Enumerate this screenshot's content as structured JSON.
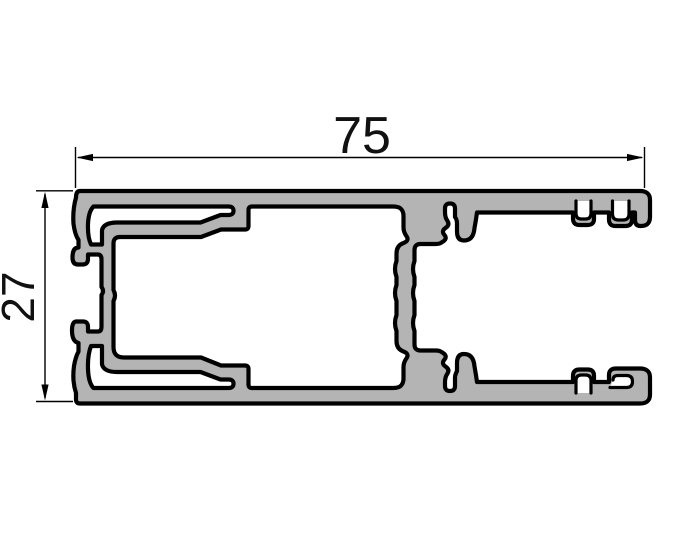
{
  "drawing": {
    "kind": "aluminium-profile-cross-section",
    "background_color": "#ffffff",
    "profile_fill_color": "#b4b4b4",
    "outline_color": "#000000",
    "dimension_line_color": "#000000",
    "dimensions": {
      "width": {
        "label": "75",
        "value": 75,
        "units": "mm",
        "orientation": "horizontal"
      },
      "height": {
        "label": "27",
        "value": 27,
        "units": "mm",
        "orientation": "vertical"
      }
    }
  }
}
